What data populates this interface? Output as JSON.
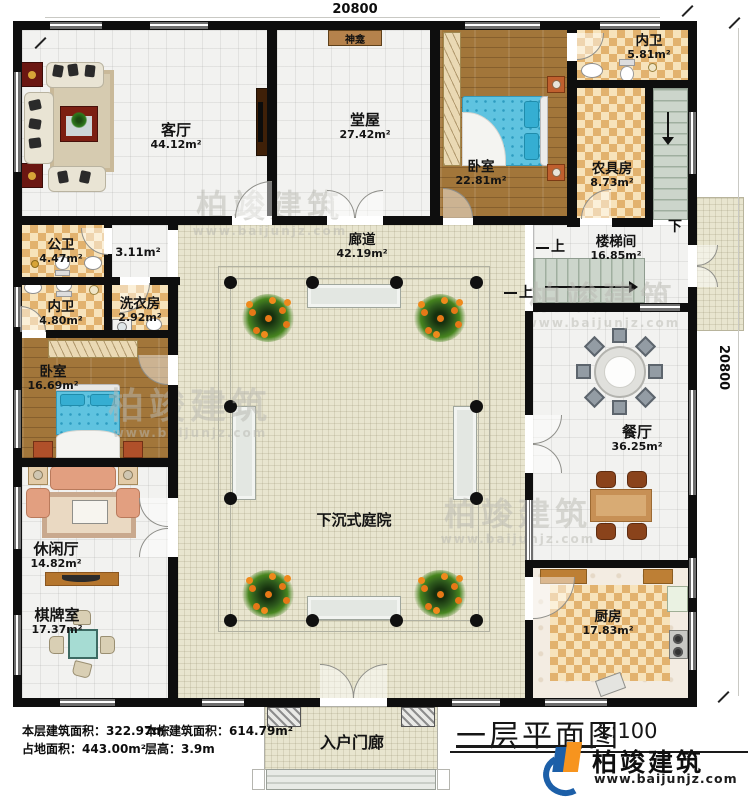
{
  "dimensions": {
    "top": "20800",
    "right": "20800"
  },
  "rooms": {
    "keting": {
      "label": "客厅",
      "area": "44.12m²"
    },
    "tangwu": {
      "label": "堂屋",
      "area": "27.42m²"
    },
    "shenkan": {
      "label": "神龛"
    },
    "woshi_top": {
      "label": "卧室",
      "area": "22.81m²"
    },
    "neiwei_top": {
      "label": "内卫",
      "area": "5.81m²"
    },
    "nongjufang": {
      "label": "农具房",
      "area": "8.73m²"
    },
    "loutijian": {
      "label": "楼梯间",
      "area": "16.85m²"
    },
    "langdao": {
      "label": "廊道",
      "area": "42.19m²"
    },
    "gongwei": {
      "label": "公卫",
      "area": "4.47m²"
    },
    "hall_small": {
      "area": "3.11m²"
    },
    "neiwei_left": {
      "label": "内卫",
      "area": "4.80m²"
    },
    "xiyifang": {
      "label": "洗衣房",
      "area": "2.92m²"
    },
    "woshi_left": {
      "label": "卧室",
      "area": "16.69m²"
    },
    "xiuxianting": {
      "label": "休闲厅",
      "area": "14.82m²"
    },
    "qipaishi": {
      "label": "棋牌室",
      "area": "17.37m²"
    },
    "canting": {
      "label": "餐厅",
      "area": "36.25m²"
    },
    "chufang": {
      "label": "厨房",
      "area": "17.83m²"
    },
    "tingyuan": {
      "label": "下沉式庭院"
    },
    "menlang": {
      "label": "入户门廊"
    }
  },
  "stairs": {
    "up_a": "上",
    "up_b": "上",
    "down": "下"
  },
  "stats": {
    "floor_area": "本层建筑面积：322.97m²",
    "land_area": "占地面积：443.00m²",
    "building_area": "本栋建筑面积：614.79m²",
    "floor_height": "层高：3.9m"
  },
  "titleblock": {
    "title": "一层平面图",
    "scale": "1:100",
    "brand": "柏竣建筑",
    "website": "www.baijunjz.com"
  },
  "watermark": {
    "brand": "柏竣建筑",
    "website": "www.baijunjz.com"
  },
  "colors": {
    "wall": "#0e0e0e",
    "wood_floor": "#a2763a",
    "tile_check": "#e2b26e",
    "corridor": "#e8e5cf",
    "brand_blue": "#1c5fa8",
    "brand_orange": "#f7941e"
  }
}
